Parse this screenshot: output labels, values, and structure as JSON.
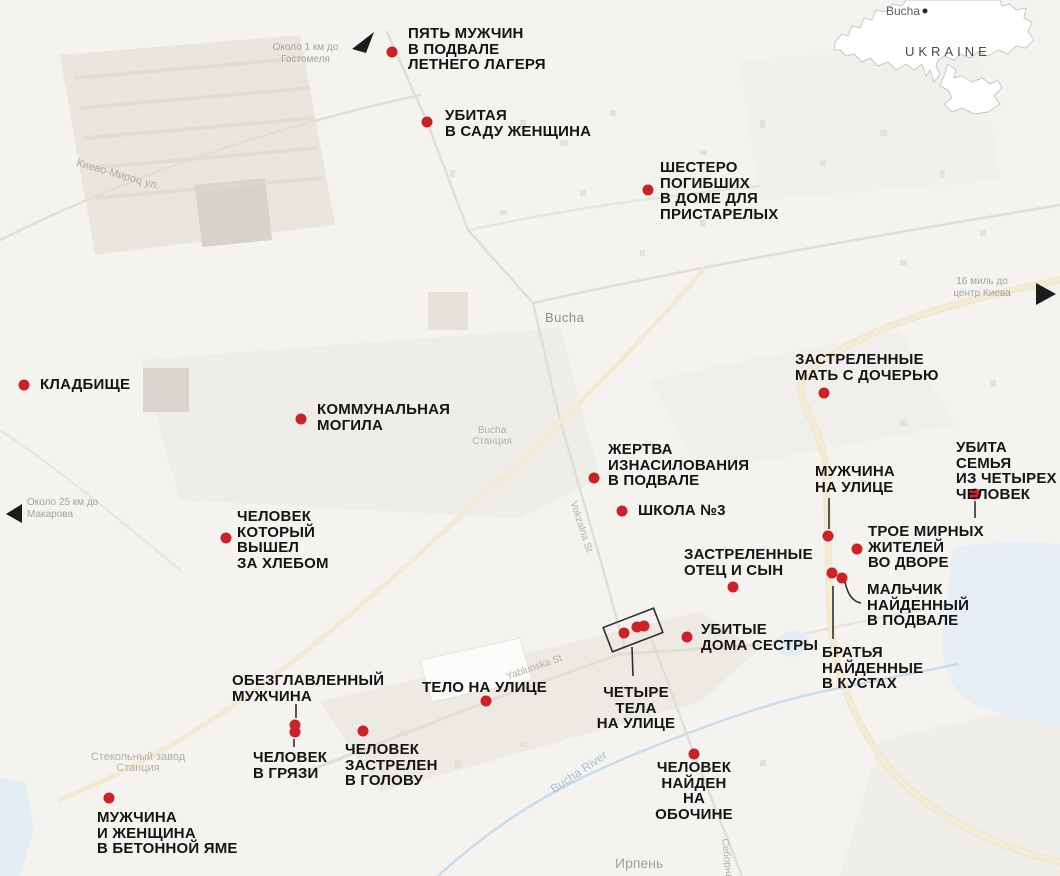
{
  "inset_map": {
    "city_label": "Bucha",
    "region_label": "UKRAINE"
  },
  "distance_notes": [
    {
      "id": "hostomel",
      "text": "Около 1 км до\nГостомеля",
      "arrow": "northwest-arrow"
    },
    {
      "id": "makarov",
      "text": "Около 25 км до\nМакарова",
      "arrow": "west-arrow"
    },
    {
      "id": "kyiv",
      "text": "16 миль до\nцентр Киева",
      "arrow": "east-arrow"
    }
  ],
  "place_labels": [
    {
      "id": "bucha-town",
      "text": "Bucha"
    },
    {
      "id": "bucha-station",
      "text": "Bucha\nСтанция"
    },
    {
      "id": "kyevo-myrots-street",
      "text": "Киево-Мироц ул."
    },
    {
      "id": "vokzalna-street",
      "text": "Vokzalna St."
    },
    {
      "id": "yablunska-street",
      "text": "Yablunska St"
    },
    {
      "id": "bucha-river",
      "text": "Bucha River"
    },
    {
      "id": "irpin-town",
      "text": "Ирпень"
    },
    {
      "id": "seborna-street",
      "text": "Себорна"
    },
    {
      "id": "glass-factory-station",
      "text": "Стекольный завод\nСтанция"
    }
  ],
  "incidents": [
    {
      "id": "five-men-camp-basement",
      "label": "ПЯТЬ МУЖЧИН\nВ ПОДВАЛЕ\nЛЕТНЕГО ЛАГЕРЯ"
    },
    {
      "id": "woman-killed-garden",
      "label": "УБИТАЯ\nВ САДУ ЖЕНЩИНА"
    },
    {
      "id": "six-dead-nursing-home",
      "label": "ШЕСТЕРО\nПОГИБШИХ\nВ ДОМЕ ДЛЯ\nПРИСТАРЕЛЫХ"
    },
    {
      "id": "mother-daughter-shot",
      "label": "ЗАСТРЕЛЕННЫЕ\nМАТЬ С ДОЧЕРЬЮ"
    },
    {
      "id": "cemetery",
      "label": "КЛАДБИЩЕ"
    },
    {
      "id": "communal-grave",
      "label": "КОММУНАЛЬНАЯ\nМОГИЛА"
    },
    {
      "id": "rape-victim-basement",
      "label": "ЖЕРТВА\nИЗНАСИЛОВАНИЯ\nВ ПОДВАЛЕ"
    },
    {
      "id": "man-on-street",
      "label": "МУЖЧИНА\nНА УЛИЦЕ"
    },
    {
      "id": "family-of-four-killed",
      "label": "УБИТА СЕМЬЯ\nИЗ ЧЕТЫРЕХ\nЧЕЛОВЕК"
    },
    {
      "id": "school-no3",
      "label": "ШКОЛА №3"
    },
    {
      "id": "man-went-for-bread",
      "label": "ЧЕЛОВЕК\nКОТОРЫЙ\nВЫШЕЛ\nЗА ХЛЕБОМ"
    },
    {
      "id": "three-civilians-yard",
      "label": "ТРОЕ МИРНЫХ\nЖИТЕЛЕЙ\nВО ДВОРЕ"
    },
    {
      "id": "father-son-shot",
      "label": "ЗАСТРЕЛЕННЫЕ\nОТЕЦ И СЫН"
    },
    {
      "id": "boy-found-basement",
      "label": "МАЛЬЧИК\nНАЙДЕННЫЙ\nВ ПОДВАЛЕ"
    },
    {
      "id": "brothers-found-bushes",
      "label": "БРАТЬЯ\nНАЙДЕННЫЕ\nВ КУСТАХ"
    },
    {
      "id": "sisters-killed-home",
      "label": "УБИТЫЕ\nДОМА СЕСТРЫ"
    },
    {
      "id": "four-bodies-street",
      "label": "ЧЕТЫРЕ ТЕЛА\nНА УЛИЦЕ"
    },
    {
      "id": "body-on-street",
      "label": "ТЕЛО НА УЛИЦЕ"
    },
    {
      "id": "beheaded-man",
      "label": "ОБЕЗГЛАВЛЕННЫЙ\nМУЖЧИНА"
    },
    {
      "id": "man-in-mud",
      "label": "ЧЕЛОВЕК\nВ ГРЯЗИ"
    },
    {
      "id": "man-shot-in-head",
      "label": "ЧЕЛОВЕК\nЗАСТРЕЛЕН\nВ ГОЛОВУ"
    },
    {
      "id": "man-woman-concrete-pit",
      "label": "МУЖЧИНА\nИ ЖЕНЩИНА\nВ БЕТОННОЙ ЯМЕ"
    },
    {
      "id": "man-found-roadside",
      "label": "ЧЕЛОВЕК\nНАЙДЕН\nНА ОБОЧИНЕ"
    }
  ],
  "colors": {
    "marker_red": "#cb2127",
    "label_black": "#151515",
    "muted_gray": "#a5a29b",
    "highway_yellow": "#f0ebd2",
    "water_blue": "#e7eef5",
    "river_blue": "#c9dcea"
  }
}
